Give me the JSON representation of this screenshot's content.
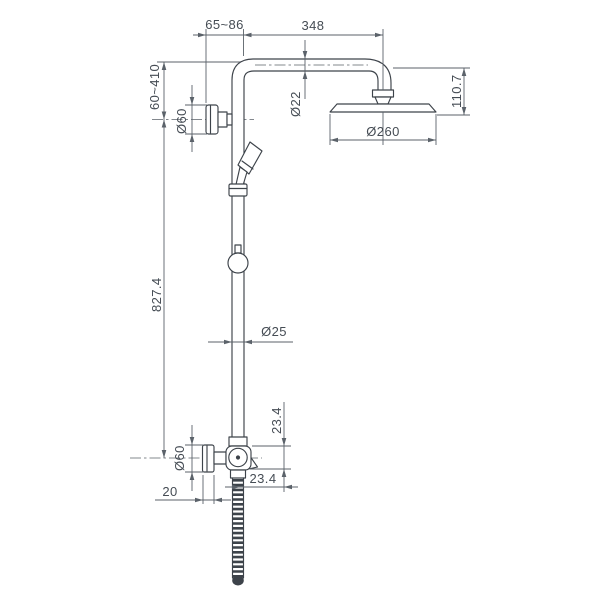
{
  "drawing": {
    "background": "#ffffff",
    "line_color": "#3d434a",
    "dim_color": "#5b626a",
    "text_color": "#454c54"
  },
  "labels": {
    "wall_distance": "65~86",
    "arm_length": "348",
    "bracket_height_range": "60~410",
    "upper_flange_diameter": "Ø60",
    "arm_pipe_diameter": "Ø22",
    "head_drop_height": "110.7",
    "head_diameter": "Ø260",
    "column_length": "827.4",
    "column_pipe_diameter": "Ø25",
    "valve_vertical_offset": "23.4",
    "lower_flange_diameter": "Ø60",
    "valve_horizontal_offset": "23.4",
    "flange_depth": "20"
  }
}
